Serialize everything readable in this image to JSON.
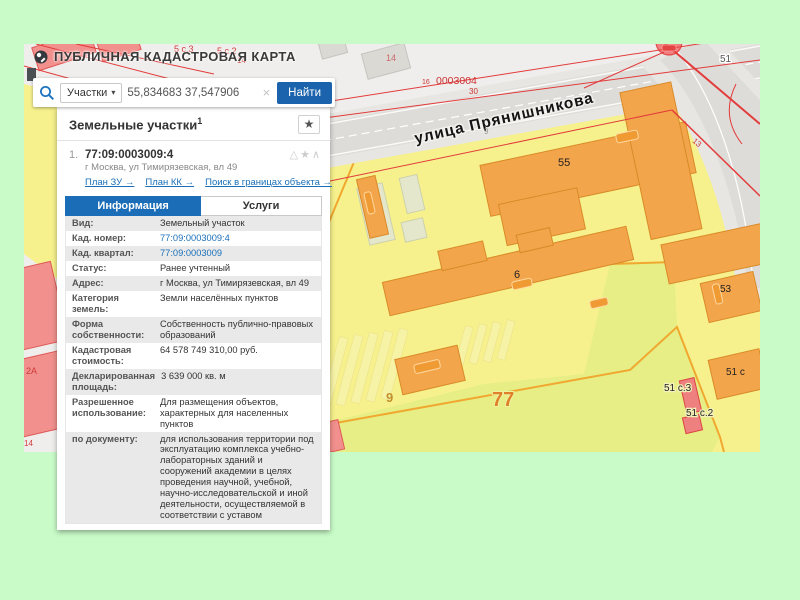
{
  "header": {
    "title": "ПУБЛИЧНАЯ КАДАСТРОВАЯ КАРТА"
  },
  "search": {
    "category": "Участки",
    "caret": "▾",
    "query": "55,834683 37,547906",
    "clear": "×",
    "button": "Найти"
  },
  "results": {
    "title": "Земельные участки",
    "count": "1",
    "favorite_icon": "★",
    "item": {
      "index": "1.",
      "cadastral_number": "77:09:0003009:4",
      "icons": "△★∧",
      "address": "г Москва, ул Тимирязевская, вл 49",
      "links": {
        "plan_zu": "План ЗУ →",
        "plan_kk": "План КК →",
        "search_in_bounds": "Поиск в границах объекта →"
      }
    },
    "tabs": [
      {
        "label": "Информация"
      },
      {
        "label": "Услуги"
      }
    ],
    "info_rows": [
      {
        "label": "Вид:",
        "value": "Земельный участок"
      },
      {
        "label": "Кад. номер:",
        "value": "77:09:0003009:4"
      },
      {
        "label": "Кад. квартал:",
        "value": "77:09:0003009"
      },
      {
        "label": "Статус:",
        "value": "Ранее учтенный"
      },
      {
        "label": "Адрес:",
        "value": "г Москва, ул Тимирязевская, вл 49"
      },
      {
        "label": "Категория земель:",
        "value": "Земли населённых пунктов"
      },
      {
        "label": "Форма собственности:",
        "value": "Собственность публично-правовых образований"
      },
      {
        "label": "Кадастровая стоимость:",
        "value": "64 578 749 310,00 руб."
      },
      {
        "label": "Декларированная площадь:",
        "value": "3 639 000 кв. м"
      },
      {
        "label": "Разрешенное использование:",
        "value": "Для размещения объектов, характерных для населенных пунктов"
      },
      {
        "label": "по документу:",
        "value": "для использования территории под эксплуатацию комплекса учебно-лабораторных зданий и сооружений академии в целях проведения научной, учебной, научно-исследовательской и иной деятельности, осуществляемой в соответствии с уставом"
      }
    ]
  },
  "map": {
    "street": "улица Прянишникова",
    "labels": {
      "parcel_77": "77",
      "parcel_9": "9",
      "bld_55": "55",
      "bld_6": "6",
      "bld_53": "53",
      "bld_51s": "51 с",
      "bld_51s3": "51 с.3",
      "bld_51s2": "51 с.2",
      "num_51": "51",
      "num_13": "13",
      "num_14a": "14",
      "num_14b": "14",
      "num_14c": "14",
      "num_16": "16",
      "num_30": "30",
      "num_9road": "9",
      "quarter_0003004": "0003004",
      "bld_5s3": "5 с.3",
      "bld_5s2": "5 с.2",
      "bld_2a": "2А",
      "bld_2ak3": "2А к.3",
      "bld_4as1": "4А с.1"
    },
    "colors": {
      "accent_blue": "#1a6db6",
      "map_yellow": "#f6f18c",
      "map_green": "#e6ee85",
      "building_orange": "#f3a54b",
      "building_pink": "#f1908c",
      "cadastral_red": "#e23b3b"
    }
  }
}
